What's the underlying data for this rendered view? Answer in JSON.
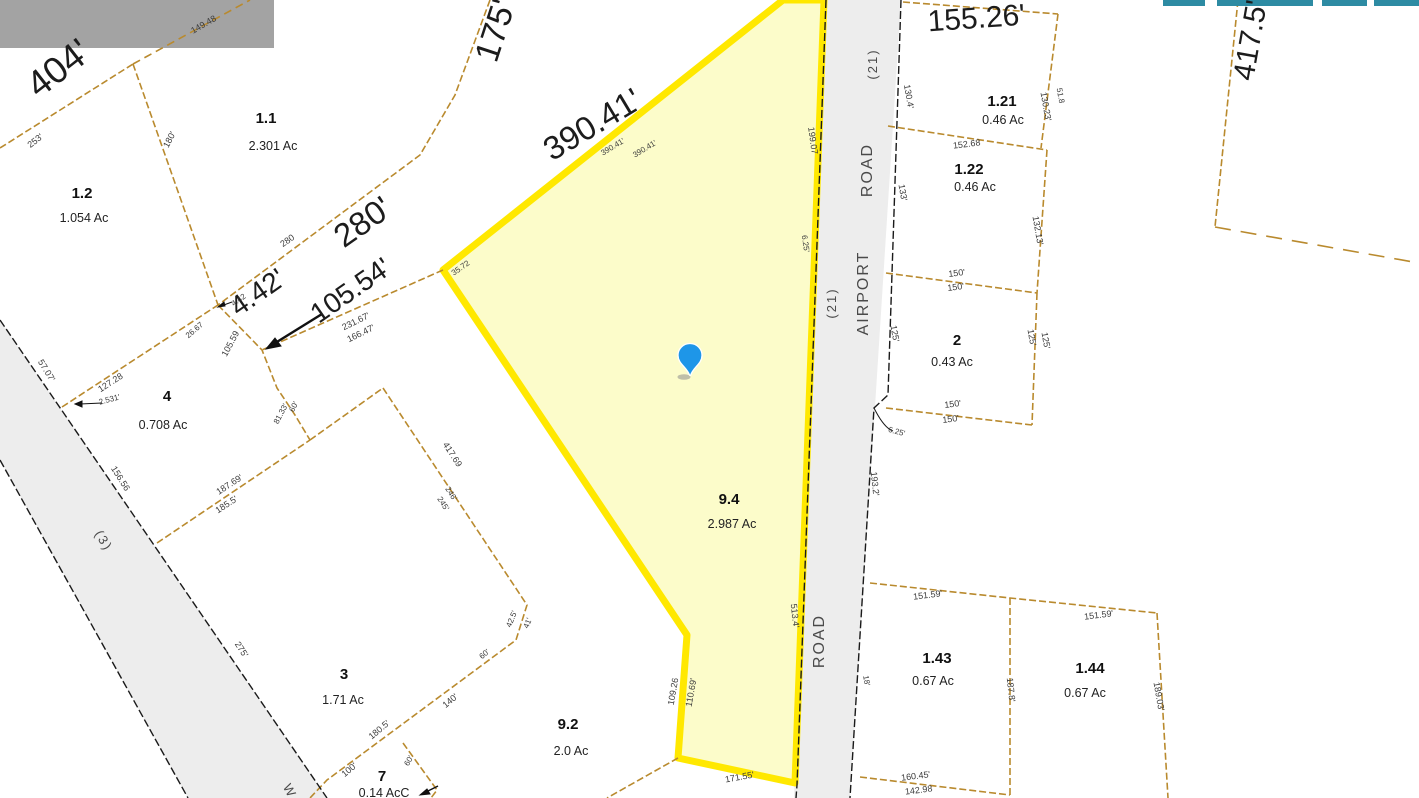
{
  "colors": {
    "highlight_border": "#ffe800",
    "highlight_fill": "#fcfcca",
    "parcel_line_tan": "#b98a2e",
    "road_fill": "#ededed",
    "pin_blue": "#1e96e8",
    "toolbar_teal": "#2d8ba3",
    "tile_gray": "#a3a3a3"
  },
  "map": {
    "highlighted_parcel": {
      "id": "9.4",
      "acreage": "2.987 Ac"
    },
    "roads": [
      {
        "label": "AIRPORT ROAD (21)"
      },
      {
        "label": "(3)"
      }
    ],
    "marker": {
      "type": "location-pin",
      "x": 690,
      "y": 358
    },
    "parcels": [
      {
        "id": "1.1",
        "ac": "2.301 Ac",
        "ix": 266,
        "iy": 123,
        "ax": 273,
        "ay": 150
      },
      {
        "id": "1.2",
        "ac": "1.054 Ac",
        "ix": 82,
        "iy": 198,
        "ax": 84,
        "ay": 222
      },
      {
        "id": "4",
        "ac": "0.708 Ac",
        "ix": 167,
        "iy": 401,
        "ax": 163,
        "ay": 429
      },
      {
        "id": "3",
        "ac": "1.71 Ac",
        "ix": 344,
        "iy": 679,
        "ax": 343,
        "ay": 704
      },
      {
        "id": "7",
        "ac": "0.14 AcC",
        "ix": 382,
        "iy": 781,
        "ax": 384,
        "ay": 797
      },
      {
        "id": "9.2",
        "ac": "2.0 Ac",
        "ix": 568,
        "iy": 729,
        "ax": 571,
        "ay": 755
      },
      {
        "id": "9.4",
        "ac": "2.987 Ac",
        "ix": 729,
        "iy": 504,
        "ax": 732,
        "ay": 528
      },
      {
        "id": "1.21",
        "ac": "0.46 Ac",
        "ix": 1002,
        "iy": 106,
        "ax": 1003,
        "ay": 124
      },
      {
        "id": "1.22",
        "ac": "0.46 Ac",
        "ix": 969,
        "iy": 174,
        "ax": 975,
        "ay": 191
      },
      {
        "id": "2",
        "ac": "0.43 Ac",
        "ix": 957,
        "iy": 345,
        "ax": 952,
        "ay": 366
      },
      {
        "id": "1.43",
        "ac": "0.67 Ac",
        "ix": 937,
        "iy": 663,
        "ax": 933,
        "ay": 685
      },
      {
        "id": "1.44",
        "ac": "0.67 Ac",
        "ix": 1090,
        "iy": 673,
        "ax": 1085,
        "ay": 697
      }
    ],
    "large_labels": [
      {
        "t": "404'",
        "x": 66,
        "y": 78,
        "r": -38,
        "s": 37
      },
      {
        "t": "175'",
        "x": 506,
        "y": 34,
        "r": -72,
        "s": 34
      },
      {
        "t": "390.41'",
        "x": 598,
        "y": 134,
        "r": -31,
        "s": 33
      },
      {
        "t": "280'",
        "x": 369,
        "y": 231,
        "r": -35,
        "s": 33
      },
      {
        "t": "4.42'",
        "x": 263,
        "y": 300,
        "r": -35,
        "s": 28
      },
      {
        "t": "105.54'",
        "x": 356,
        "y": 298,
        "r": -35,
        "s": 28
      },
      {
        "t": "155.26'",
        "x": 977,
        "y": 28,
        "r": -4,
        "s": 30
      },
      {
        "t": "417.5'",
        "x": 1260,
        "y": 42,
        "r": -80,
        "s": 30
      }
    ],
    "small_labels": [
      {
        "t": "149.48",
        "x": 205,
        "y": 27,
        "r": -30,
        "s": 9
      },
      {
        "t": "253'",
        "x": 37,
        "y": 143,
        "r": -38,
        "s": 9
      },
      {
        "t": "180'",
        "x": 172,
        "y": 141,
        "r": -62,
        "s": 9
      },
      {
        "t": "280",
        "x": 289,
        "y": 243,
        "r": -35,
        "s": 9
      },
      {
        "t": "390.41'",
        "x": 614,
        "y": 149,
        "r": -31,
        "s": 8
      },
      {
        "t": "390.41'",
        "x": 646,
        "y": 151,
        "r": -31,
        "s": 8
      },
      {
        "t": "35.72",
        "x": 462,
        "y": 270,
        "r": -35,
        "s": 8
      },
      {
        "t": "231.67'",
        "x": 357,
        "y": 324,
        "r": -26,
        "s": 9
      },
      {
        "t": "166.47'",
        "x": 362,
        "y": 336,
        "r": -26,
        "s": 9
      },
      {
        "t": "4.42",
        "x": 240,
        "y": 302,
        "r": -35,
        "s": 8
      },
      {
        "t": "26.67",
        "x": 196,
        "y": 332,
        "r": -40,
        "s": 8
      },
      {
        "t": "105.59",
        "x": 233,
        "y": 345,
        "r": -62,
        "s": 9
      },
      {
        "t": "127.28",
        "x": 112,
        "y": 385,
        "r": -33,
        "s": 9
      },
      {
        "t": "2.531'",
        "x": 110,
        "y": 402,
        "r": -15,
        "s": 8
      },
      {
        "t": "57.07'",
        "x": 44,
        "y": 372,
        "r": 58,
        "s": 9
      },
      {
        "t": "156.56",
        "x": 118,
        "y": 480,
        "r": 58,
        "s": 9
      },
      {
        "t": "187.69'",
        "x": 231,
        "y": 487,
        "r": -33,
        "s": 9
      },
      {
        "t": "185.5'",
        "x": 228,
        "y": 507,
        "r": -33,
        "s": 9
      },
      {
        "t": "60'",
        "x": 296,
        "y": 408,
        "r": -62,
        "s": 8
      },
      {
        "t": "81.33'",
        "x": 283,
        "y": 415,
        "r": -62,
        "s": 8
      },
      {
        "t": "275'",
        "x": 239,
        "y": 651,
        "r": 57,
        "s": 9
      },
      {
        "t": "246'",
        "x": 449,
        "y": 495,
        "r": 57,
        "s": 8
      },
      {
        "t": "245'",
        "x": 441,
        "y": 505,
        "r": 57,
        "s": 8
      },
      {
        "t": "42.5'",
        "x": 514,
        "y": 620,
        "r": -68,
        "s": 8
      },
      {
        "t": "41'",
        "x": 530,
        "y": 624,
        "r": -68,
        "s": 8
      },
      {
        "t": "60'",
        "x": 486,
        "y": 656,
        "r": -40,
        "s": 8
      },
      {
        "t": "140'",
        "x": 452,
        "y": 703,
        "r": -40,
        "s": 9
      },
      {
        "t": "180.5'",
        "x": 381,
        "y": 732,
        "r": -40,
        "s": 9
      },
      {
        "t": "100'",
        "x": 351,
        "y": 772,
        "r": -40,
        "s": 9
      },
      {
        "t": "60'",
        "x": 411,
        "y": 762,
        "r": -60,
        "s": 8
      },
      {
        "t": "417.69",
        "x": 450,
        "y": 456,
        "r": 57,
        "s": 9
      },
      {
        "t": "199.07",
        "x": 810,
        "y": 141,
        "r": 82,
        "s": 9
      },
      {
        "t": "6.25'",
        "x": 803,
        "y": 244,
        "r": 82,
        "s": 8
      },
      {
        "t": "513.4'",
        "x": 792,
        "y": 616,
        "r": 84,
        "s": 9
      },
      {
        "t": "109.26",
        "x": 676,
        "y": 692,
        "r": -80,
        "s": 9
      },
      {
        "t": "110.69'",
        "x": 694,
        "y": 693,
        "r": -80,
        "s": 9
      },
      {
        "t": "171.55'",
        "x": 740,
        "y": 780,
        "r": -10,
        "s": 9
      },
      {
        "t": "130.4'",
        "x": 906,
        "y": 97,
        "r": 80,
        "s": 9
      },
      {
        "t": "130.23'",
        "x": 1043,
        "y": 107,
        "r": 80,
        "s": 9
      },
      {
        "t": "51.8",
        "x": 1058,
        "y": 96,
        "r": 80,
        "s": 8
      },
      {
        "t": "152.68",
        "x": 967,
        "y": 147,
        "r": -7,
        "s": 9
      },
      {
        "t": "133'",
        "x": 900,
        "y": 193,
        "r": 80,
        "s": 9
      },
      {
        "t": "132.13'",
        "x": 1035,
        "y": 231,
        "r": 80,
        "s": 9
      },
      {
        "t": "150'",
        "x": 957,
        "y": 276,
        "r": -7,
        "s": 9
      },
      {
        "t": "150'",
        "x": 956,
        "y": 290,
        "r": -7,
        "s": 9
      },
      {
        "t": "125'",
        "x": 892,
        "y": 334,
        "r": 80,
        "s": 9
      },
      {
        "t": "125'",
        "x": 1029,
        "y": 338,
        "r": 80,
        "s": 9
      },
      {
        "t": "125'",
        "x": 1043,
        "y": 341,
        "r": 80,
        "s": 9
      },
      {
        "t": "150'",
        "x": 953,
        "y": 407,
        "r": -7,
        "s": 9
      },
      {
        "t": "150'",
        "x": 951,
        "y": 422,
        "r": -7,
        "s": 9
      },
      {
        "t": "6.25'",
        "x": 896,
        "y": 434,
        "r": 15,
        "s": 8
      },
      {
        "t": "193.2'",
        "x": 872,
        "y": 484,
        "r": 84,
        "s": 9
      },
      {
        "t": "151.59'",
        "x": 928,
        "y": 598,
        "r": -7,
        "s": 9
      },
      {
        "t": "151.59'",
        "x": 1099,
        "y": 618,
        "r": -7,
        "s": 9
      },
      {
        "t": "18'",
        "x": 864,
        "y": 681,
        "r": 80,
        "s": 8
      },
      {
        "t": "187.8'",
        "x": 1008,
        "y": 690,
        "r": 84,
        "s": 9
      },
      {
        "t": "189.03'",
        "x": 1156,
        "y": 697,
        "r": 80,
        "s": 9
      },
      {
        "t": "160.45'",
        "x": 916,
        "y": 779,
        "r": -7,
        "s": 9
      },
      {
        "t": "142.98",
        "x": 919,
        "y": 793,
        "r": -7,
        "s": 9
      }
    ],
    "road_labels": [
      {
        "t": "(21)",
        "x": 877,
        "y": 64,
        "r": -90,
        "s": 13
      },
      {
        "t": "ROAD",
        "x": 872,
        "y": 170,
        "r": -90,
        "s": 16
      },
      {
        "t": "AIRPORT",
        "x": 868,
        "y": 293,
        "r": -90,
        "s": 16
      },
      {
        "t": "(21)",
        "x": 836,
        "y": 303,
        "r": -90,
        "s": 13
      },
      {
        "t": "ROAD",
        "x": 824,
        "y": 641,
        "r": -90,
        "s": 16
      },
      {
        "t": "(3)",
        "x": 100,
        "y": 543,
        "r": 58,
        "s": 13
      },
      {
        "t": "W",
        "x": 286,
        "y": 793,
        "r": 62,
        "s": 13
      }
    ]
  },
  "ui_fragments": {
    "teal_bars": [
      {
        "x": 1163,
        "w": 42
      },
      {
        "x": 1217,
        "w": 96
      },
      {
        "x": 1322,
        "w": 45
      },
      {
        "x": 1374,
        "w": 45
      }
    ],
    "unloaded_tile": {
      "x": 0,
      "y": 0,
      "w": 274,
      "h": 48
    }
  }
}
